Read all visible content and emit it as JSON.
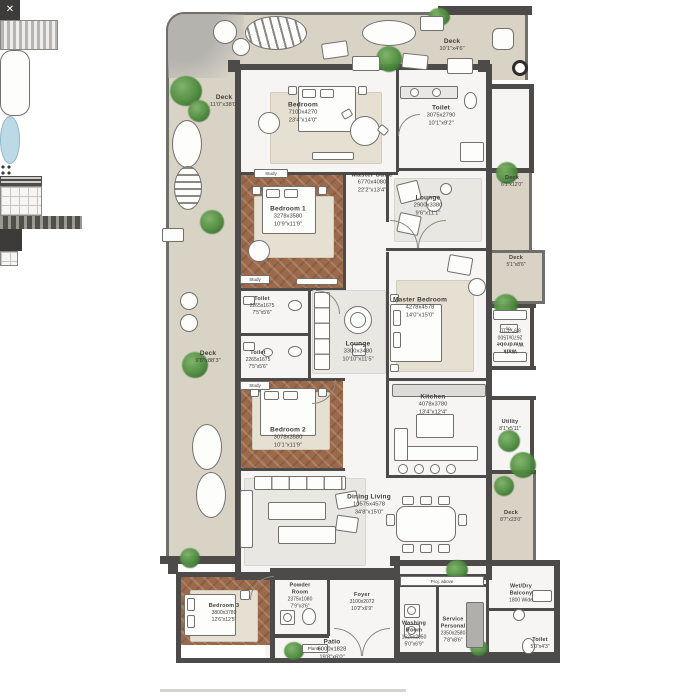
{
  "colors": {
    "wall": "#4c4b49",
    "deck_floor": "#d9d3c6",
    "indoor_floor": "#f6f5f3",
    "wood_floor": "#9c6a4a",
    "greenery": "#3e7a33",
    "bathtub_water": "#bcd9e6"
  },
  "rooms": {
    "deck_top_left": {
      "name": "Deck",
      "ft": "11'0\"x38'0\""
    },
    "deck_top_right": {
      "name": "Deck",
      "ft": "10'1\"x4'6\""
    },
    "deck_left": {
      "name": "Deck",
      "ft": "9'8\"x88'3\""
    },
    "deck_right_upper": {
      "name": "Deck",
      "ft": "6'1\"x12'0\""
    },
    "deck_right_mid": {
      "name": "Deck",
      "ft": "5'1\"x8'6\""
    },
    "deck_right_lower": {
      "name": "Deck",
      "ft": "8'7\"x23'0\""
    },
    "patio": {
      "name": "Patio",
      "mm": "6000x1828",
      "ft": "19'8\"x6'0\""
    },
    "bedroom_top": {
      "name": "Bedroom",
      "mm": "7100x4270",
      "ft": "23'4\"x14'0\""
    },
    "toilet_top": {
      "name": "Toilet",
      "mm": "3075x2790",
      "ft": "10'1\"x9'2\""
    },
    "master_suite": {
      "name": "Master Suite",
      "mm": "6770x4080",
      "ft": "22'2\"x13'4\""
    },
    "lounge_top": {
      "name": "Lounge",
      "mm": "2900x3380",
      "ft": "9'6\"x11'1\""
    },
    "bedroom1": {
      "name": "Bedroom 1",
      "mm": "3278x3580",
      "ft": "10'9\"x11'9\""
    },
    "toilet_mid_upper": {
      "name": "Toilet",
      "mm": "2265x1675",
      "ft": "7'5\"x5'6\""
    },
    "toilet_mid_lower": {
      "name": "Toilet",
      "mm": "2265x1675",
      "ft": "7'5\"x5'6\""
    },
    "lounge_mid": {
      "name": "Lounge",
      "mm": "3300x3480",
      "ft": "10'10\"x11'5\""
    },
    "master_bedroom": {
      "name": "Master Bedroom",
      "mm": "4278x4578",
      "ft": "14'0\"x15'0\""
    },
    "walk_wardrobe": {
      "name": "Walk Wardrobe",
      "mm": "2670x1500",
      "ft": "8'9\"x4'11\""
    },
    "bedroom2": {
      "name": "Bedroom 2",
      "mm": "3078x3580",
      "ft": "10'1\"x11'9\""
    },
    "kitchen": {
      "name": "Kitchen",
      "mm": "4078x3780",
      "ft": "13'4\"x12'4\""
    },
    "utility": {
      "name": "Utility",
      "ft": "8'1\"x5'11\""
    },
    "dining_living": {
      "name": "Dining Living",
      "mm": "10575x4578",
      "ft": "34'8\"x15'0\""
    },
    "bedroom3": {
      "name": "Bedroom 3",
      "mm": "3800x3780",
      "ft": "12'6\"x12'5\""
    },
    "powder_room": {
      "name": "Powder Room",
      "mm": "2375x1080",
      "ft": "7'9\"x3'6\""
    },
    "foyer": {
      "name": "Foyer",
      "mm": "3100x2072",
      "ft": "10'2\"x6'9\""
    },
    "washing_room": {
      "name": "Washing Room",
      "mm": "1525x2050",
      "ft": "5'0\"x6'9\""
    },
    "service_personal": {
      "name": "Service Personal",
      "mm": "2350x2580",
      "ft": "7'8\"x8'6\""
    },
    "wet_dry_balcony": {
      "name": "Wet/Dry Balcony",
      "note": "1800 Wide"
    },
    "toilet_service": {
      "name": "Toilet",
      "ft": "5'0\"x4'3\""
    }
  },
  "tags": {
    "study": "Study",
    "linen": "lin.",
    "proj_above": "Proj. above",
    "planter": "Planter",
    "shaft_mark": "✕"
  }
}
